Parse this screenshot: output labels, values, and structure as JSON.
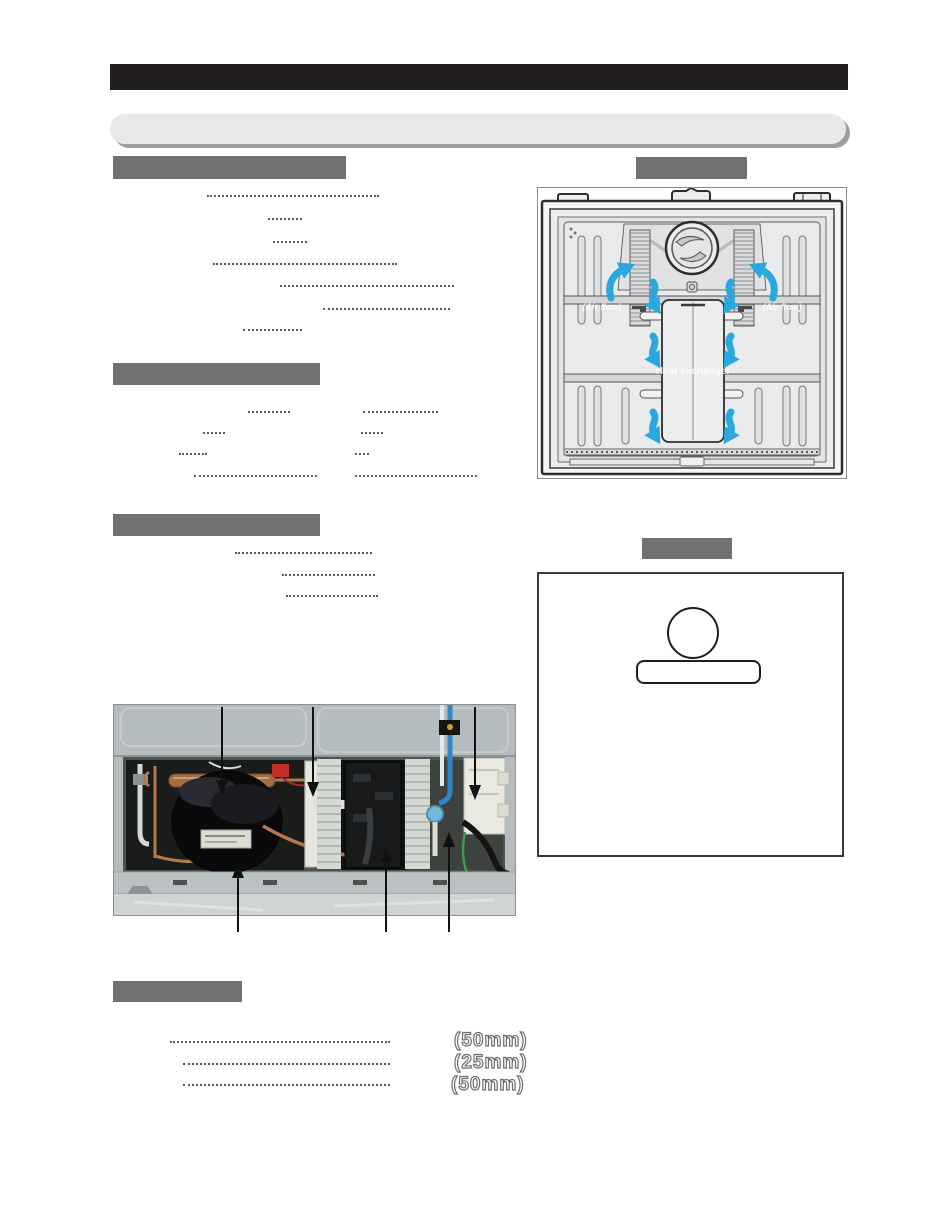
{
  "document": {
    "type": "service-manual-page",
    "colors": {
      "title_bar": "#231f20",
      "section_header": "#717171",
      "subtitle_pill": "#e8e8e8",
      "airflow_arrow_blue": "#29a8e0"
    }
  },
  "airflow_figure": {
    "label_air_flow_left": "(Air flow)",
    "label_air_flow_right": "(Air flow)",
    "label_heat_exchanger": "Heat exchanger"
  },
  "clearance_section": {
    "measurements": [
      "(50mm)",
      "(25mm)",
      "(50mm)"
    ]
  }
}
